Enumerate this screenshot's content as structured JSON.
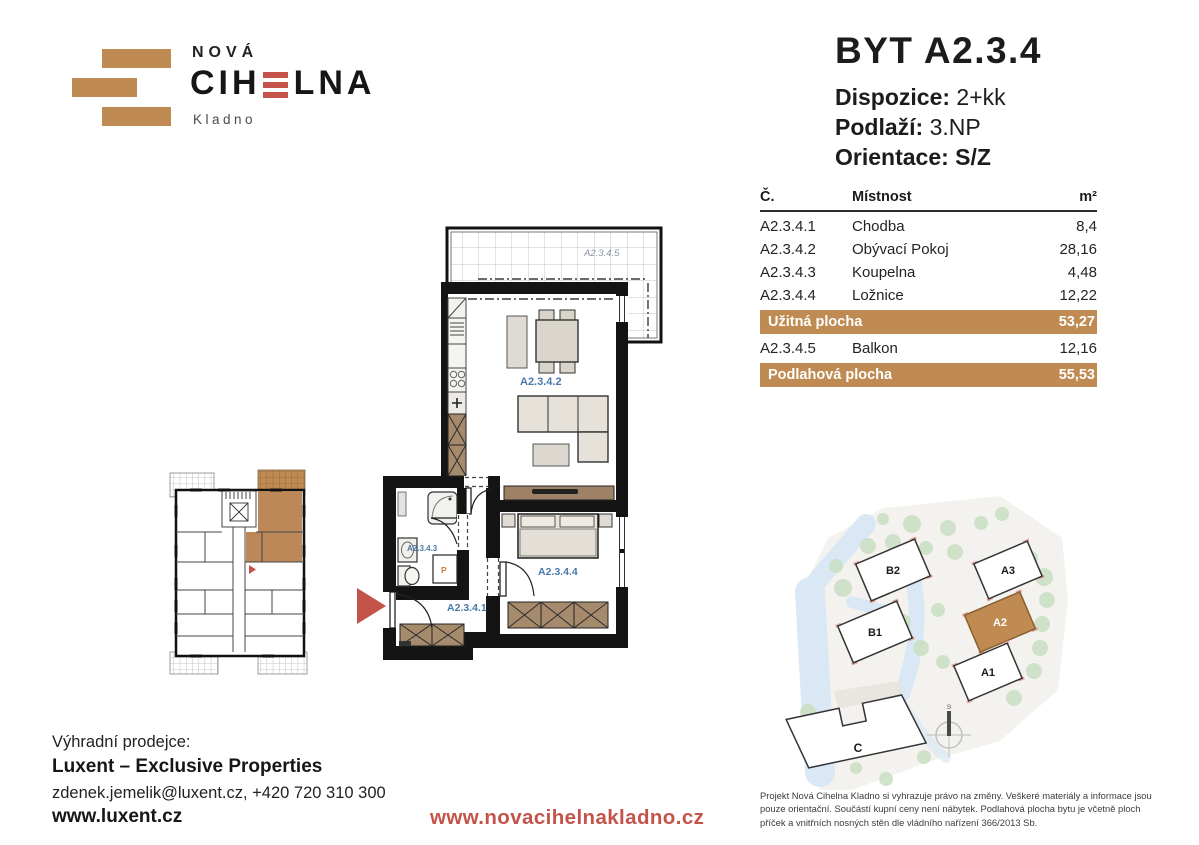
{
  "logo": {
    "nova": "NOVÁ",
    "cihelna_pre": "CIH",
    "cihelna_post": "LNA",
    "city": "Kladno"
  },
  "header": {
    "title": "BYT A2.3.4",
    "dispozice_label": "Dispozice:",
    "dispozice_value": "2+kk",
    "podlazi_label": "Podlaží:",
    "podlazi_value": "3.NP",
    "orientace_label": "Orientace:",
    "orientace_value": "S/Z"
  },
  "table": {
    "col_num": "Č.",
    "col_room": "Místnost",
    "col_area": "m²",
    "rows": [
      {
        "num": "A2.3.4.1",
        "room": "Chodba",
        "area": "8,4"
      },
      {
        "num": "A2.3.4.2",
        "room": "Obývací Pokoj",
        "area": "28,16"
      },
      {
        "num": "A2.3.4.3",
        "room": "Koupelna",
        "area": "4,48"
      },
      {
        "num": "A2.3.4.4",
        "room": "Ložnice",
        "area": "12,22"
      }
    ],
    "uzitna_label": "Užitná plocha",
    "uzitna_value": "53,27",
    "balkon": {
      "num": "A2.3.4.5",
      "room": "Balkon",
      "area": "12,16"
    },
    "podlahova_label": "Podlahová plocha",
    "podlahova_value": "55,53"
  },
  "plan": {
    "labels": {
      "hall": "A2.3.4.1",
      "living": "A2.3.4.2",
      "bath": "A2.3.4.3",
      "bedroom": "A2.3.4.4",
      "balcony": "A2.3.4.5"
    },
    "washer": "P"
  },
  "site": {
    "buildings": {
      "b2": "B2",
      "b1": "B1",
      "a3": "A3",
      "a2": "A2",
      "a1": "A1",
      "c": "C"
    },
    "compass": "S"
  },
  "footer": {
    "seller_label": "Výhradní prodejce:",
    "seller_name": "Luxent – Exclusive Properties",
    "contact": "zdenek.jemelik@luxent.cz, +420 720 310 300",
    "luxent_url": "www.luxent.cz",
    "project_url": "www.novacihelnakladno.cz",
    "disclaimer": "Projekt Nová Cihelna Kladno si vyhrazuje právo na změny. Veškeré materiály a informace jsou pouze orientační. Součástí kupní ceny není nábytek. Podlahová plocha bytu je včetně ploch příček a vnitřních nosných stěn dle vládního nařízení 366/2013 Sb."
  },
  "colors": {
    "tan": "#bf8b52",
    "red": "#c4544a",
    "label_blue": "#4a7aa8"
  }
}
